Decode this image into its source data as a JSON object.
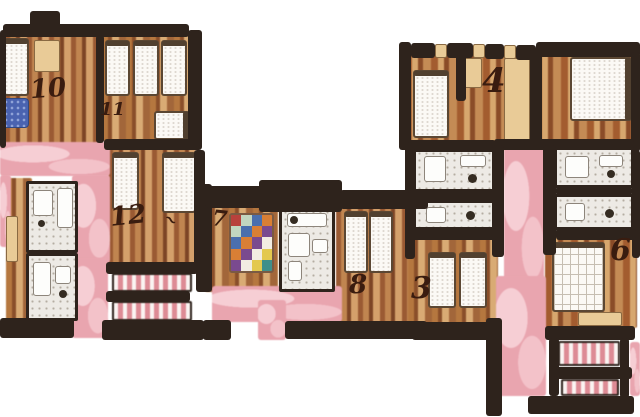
{
  "plan": {
    "kind": "hand-drawn watercolor floor plan, two wings joined by corridors"
  },
  "rooms": [
    {
      "id": "room-10",
      "number": "10"
    },
    {
      "id": "room-11",
      "number": "11"
    },
    {
      "id": "room-12",
      "number": "12"
    },
    {
      "id": "room-7",
      "number": "7"
    },
    {
      "id": "room-8",
      "number": "8"
    },
    {
      "id": "room-3",
      "number": "3"
    },
    {
      "id": "room-4",
      "number": "4"
    },
    {
      "id": "room-6",
      "number": "6"
    }
  ],
  "decor_mark": "~",
  "palette": {
    "wall": "#2e231c",
    "corridor_pink": "#e9a5af",
    "corridor_pink_light": "#f6ced4",
    "wood_dark": "#8a4f2e",
    "wood_mid": "#b5723f",
    "wood_light": "#d9ab74",
    "tile_gray": "#edeae5",
    "ink": "#3a1c0f",
    "rug_blue": "#4a63b0"
  },
  "quilt": {
    "colors": [
      "#b8413c",
      "#3f8f8a",
      "#e3c84e",
      "#f2ece2",
      "#7a4a8f",
      "#d97f35",
      "#4a6fae",
      "#c2d6c0"
    ]
  }
}
